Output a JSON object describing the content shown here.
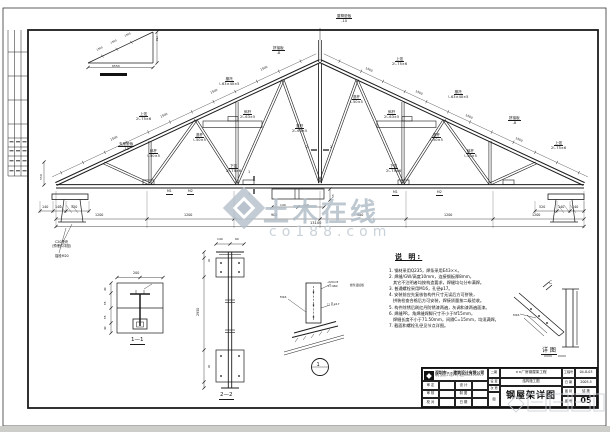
{
  "watermark": {
    "brand": "土木在线",
    "domain": "co188.com",
    "accent": "#b0bcc7"
  },
  "notes": {
    "title": "说 明:",
    "lines": [
      "1. 钢材采用Q235，焊条采用E43××。",
      "2. 焊缝/GW/高度10mm，连接钢板厚8mm，",
      "   其它不注明者均按构造要求，焊缝均匀分布满焊。",
      "3. 普通螺栓采用M16，孔径φ17。",
      "4. 安装前应先复核各构件尺寸无误后方可拼装，",
      "   拼装检查合格后方可安装，焊接质量按二级验收。",
      "5. 构件除锈后刷红丹防锈漆两遍，灰调和漆两遍面漆。",
      "6. 焊缝PR，角焊缝焊脚尺寸不小于hf15mm，",
      "   焊缝长度不小于71.50mm，间隔C=15mm，均须满焊。",
      "7. 截面和螺栓孔径见节点详图。"
    ]
  },
  "titleblock": {
    "company": "深圳市××建筑设计有限公司",
    "address": "地址:深圳市××路××号  电话:0755-×××××××",
    "sign_rows": [
      [
        "审 定",
        "设 计"
      ],
      [
        "审 核",
        "制 图"
      ],
      [
        "校 对",
        "日 期"
      ]
    ],
    "col2": [
      "二期",
      "设 变",
      "次 更",
      "图"
    ],
    "project": "××厂房钢屋架工程",
    "stage": "结构施工图",
    "drawing_title": "钢屋架详图",
    "fields": [
      [
        "工程号",
        "04-8-03"
      ],
      [
        "日 期",
        "2005.5"
      ],
      [
        "图 别",
        "结 施"
      ],
      [
        "图 号",
        "05"
      ]
    ]
  },
  "annotations": [
    {
      "x": 136,
      "y": 112,
      "t": "上弦\n2∟75×6",
      "u": 1
    },
    {
      "x": 219,
      "y": 77,
      "t": "檩托\n∟63×40×5",
      "u": 1
    },
    {
      "x": 272,
      "y": 46,
      "t": "拼接板\n-8",
      "u": 1
    },
    {
      "x": 336,
      "y": 14,
      "t": "屋脊垫板\n-10",
      "u": 1
    },
    {
      "x": 392,
      "y": 57,
      "t": "上弦\n2∟75×6",
      "u": 1
    },
    {
      "x": 448,
      "y": 90,
      "t": "檩托\n∟63×40×5",
      "u": 1
    },
    {
      "x": 508,
      "y": 116,
      "t": "拼接板\n-8",
      "u": 1
    },
    {
      "x": 551,
      "y": 141,
      "t": "上弦\n2∟75×6",
      "u": 1
    },
    {
      "x": 147,
      "y": 149,
      "t": "斜杆\n∟50×5",
      "u": 1
    },
    {
      "x": 193,
      "y": 133,
      "t": "竖杆\n∟50×5",
      "u": 1
    },
    {
      "x": 240,
      "y": 110,
      "t": "斜杆\n2∟63×5",
      "u": 1
    },
    {
      "x": 292,
      "y": 124,
      "t": "竖杆\n2∟63×5",
      "u": 1
    },
    {
      "x": 350,
      "y": 95,
      "t": "竖杆\n∟50×5",
      "u": 1
    },
    {
      "x": 384,
      "y": 110,
      "t": "斜杆\n2∟63×5",
      "u": 1
    },
    {
      "x": 430,
      "y": 133,
      "t": "竖杆\n∟50×5",
      "u": 1
    },
    {
      "x": 464,
      "y": 149,
      "t": "斜杆\n∟50×5",
      "u": 1
    },
    {
      "x": 226,
      "y": 164,
      "t": "下弦\n2∟75×6",
      "u": 1
    },
    {
      "x": 386,
      "y": 164,
      "t": "下弦\n2∟75×6",
      "u": 1
    },
    {
      "x": 118,
      "y": 142,
      "t": "支座垫板\n-12",
      "u": 1
    },
    {
      "x": 166,
      "y": 190,
      "t": "M1",
      "u": 1,
      "s": 3.2
    },
    {
      "x": 187,
      "y": 190,
      "t": "M2",
      "u": 1,
      "s": 3.2
    },
    {
      "x": 392,
      "y": 191,
      "t": "M1",
      "u": 1,
      "s": 3.2
    },
    {
      "x": 436,
      "y": 191,
      "t": "M2",
      "u": 1,
      "s": 3.2
    },
    {
      "x": 52,
      "y": 241,
      "t": "C20垫块\n(预埋件详图)",
      "s": 3.3
    },
    {
      "x": 55,
      "y": 255,
      "t": "锚栓M20",
      "s": 3.3
    },
    {
      "x": 110,
      "y": 139,
      "t": "1500",
      "r": -25,
      "s": 3
    },
    {
      "x": 160,
      "y": 116,
      "t": "1500",
      "r": -25,
      "s": 3
    },
    {
      "x": 210,
      "y": 92,
      "t": "1500",
      "r": -25,
      "s": 3
    },
    {
      "x": 260,
      "y": 69,
      "t": "1500",
      "r": -25,
      "s": 3
    },
    {
      "x": 366,
      "y": 67,
      "t": "1500",
      "r": 25,
      "s": 3
    },
    {
      "x": 416,
      "y": 90,
      "t": "1500",
      "r": 25,
      "s": 3
    },
    {
      "x": 466,
      "y": 114,
      "t": "1500",
      "r": 25,
      "s": 3
    },
    {
      "x": 516,
      "y": 137,
      "t": "1500",
      "r": 25,
      "s": 3
    },
    {
      "x": 42,
      "y": 205.5,
      "t": "140",
      "s": 3.3
    },
    {
      "x": 55,
      "y": 205.5,
      "t": "140",
      "s": 3.3
    },
    {
      "x": 71,
      "y": 205.5,
      "t": "520",
      "s": 3.3
    },
    {
      "x": 539,
      "y": 205.5,
      "t": "520",
      "s": 3.3
    },
    {
      "x": 558,
      "y": 205.5,
      "t": "140",
      "s": 3.3
    },
    {
      "x": 572,
      "y": 205.5,
      "t": "140",
      "s": 3.3
    },
    {
      "x": 95,
      "y": 213.5,
      "t": "1200",
      "s": 3.3
    },
    {
      "x": 184,
      "y": 213.5,
      "t": "1200",
      "s": 3.3
    },
    {
      "x": 271,
      "y": 213.5,
      "t": "900",
      "s": 3.3
    },
    {
      "x": 357,
      "y": 213.5,
      "t": "900",
      "s": 3.3
    },
    {
      "x": 444,
      "y": 213.5,
      "t": "1200",
      "s": 3.3
    },
    {
      "x": 532,
      "y": 213.5,
      "t": "1200",
      "s": 3.3
    },
    {
      "x": 310,
      "y": 221,
      "t": "13100",
      "s": 3.6
    },
    {
      "x": 280,
      "y": 203.5,
      "t": "140",
      "s": 3
    },
    {
      "x": 303,
      "y": 203.5,
      "t": "140",
      "s": 3
    },
    {
      "x": 332,
      "y": 198,
      "t": "55",
      "r": -90,
      "s": 3
    },
    {
      "x": 40,
      "y": 180,
      "t": "550",
      "r": -90,
      "s": 3
    },
    {
      "x": 306,
      "y": 145,
      "t": "2",
      "s": 3.4
    },
    {
      "x": 330,
      "y": 145,
      "t": "2",
      "s": 3.4
    },
    {
      "x": 248,
      "y": 170,
      "t": "1",
      "s": 3.4
    },
    {
      "x": 248,
      "y": 192,
      "t": "1",
      "s": 3.4
    },
    {
      "x": 96,
      "y": 49,
      "t": "1500",
      "r": -25,
      "s": 2.6
    },
    {
      "x": 110,
      "y": 42,
      "t": "1500",
      "r": -25,
      "s": 2.6
    },
    {
      "x": 124,
      "y": 35,
      "t": "1500",
      "r": -25,
      "s": 2.6
    },
    {
      "x": 158,
      "y": 36,
      "t": "750",
      "r": 90,
      "s": 2.8
    },
    {
      "x": 112,
      "y": 64.5,
      "t": "6550",
      "s": 3
    },
    {
      "x": 133,
      "y": 271.5,
      "t": "200",
      "s": 3.3
    },
    {
      "x": 104,
      "y": 291,
      "t": "40",
      "r": -90,
      "s": 2.8
    },
    {
      "x": 104,
      "y": 305,
      "t": "65",
      "r": -90,
      "s": 2.8
    },
    {
      "x": 104,
      "y": 319,
      "t": "65",
      "r": -90,
      "s": 2.8
    },
    {
      "x": 104,
      "y": 330,
      "t": "40",
      "r": -90,
      "s": 2.8
    },
    {
      "x": 130,
      "y": 337,
      "t": "1—1",
      "s": 5.5,
      "u": 1
    },
    {
      "x": 217,
      "y": 238,
      "t": "140",
      "s": 3
    },
    {
      "x": 235,
      "y": 238,
      "t": "60",
      "s": 3
    },
    {
      "x": 197,
      "y": 316,
      "t": "2950",
      "r": -90,
      "s": 3.3
    },
    {
      "x": 208,
      "y": 262,
      "t": "90",
      "r": -90,
      "s": 2.6
    },
    {
      "x": 208,
      "y": 368,
      "t": "90",
      "r": -90,
      "s": 2.6
    },
    {
      "x": 219,
      "y": 392,
      "t": "2—2",
      "s": 5.5,
      "u": 1
    },
    {
      "x": 327,
      "y": 281,
      "t": "-220×8\nL=460",
      "s": 3
    },
    {
      "x": 350,
      "y": 284,
      "t": "檩条连接板",
      "s": 2.8
    },
    {
      "x": 327,
      "y": 303,
      "t": "□ 孔φ17",
      "s": 3
    },
    {
      "x": 280,
      "y": 296,
      "t": "M16",
      "s": 3
    },
    {
      "x": 316.5,
      "y": 361.5,
      "t": "1",
      "s": 5
    },
    {
      "x": 549,
      "y": 281,
      "t": "C",
      "s": 4.5
    },
    {
      "x": 513,
      "y": 314,
      "t": "M16",
      "s": 3
    },
    {
      "x": 541,
      "y": 347,
      "t": "详 图",
      "s": 6,
      "u": 1
    }
  ]
}
